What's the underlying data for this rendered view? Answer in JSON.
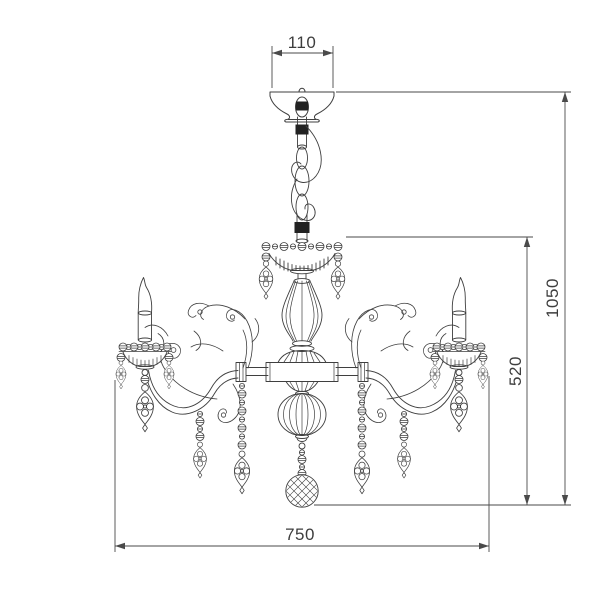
{
  "drawing": {
    "type": "technical-line-drawing",
    "subject": "classic crystal chandelier with scroll arms, candle sleeves, bead chains and drop pendants",
    "background": "#ffffff",
    "line_color": "#3f3f3f",
    "dimensions": {
      "canopy_width": "110",
      "overall_width": "750",
      "body_height": "520",
      "overall_height": "1050"
    }
  }
}
